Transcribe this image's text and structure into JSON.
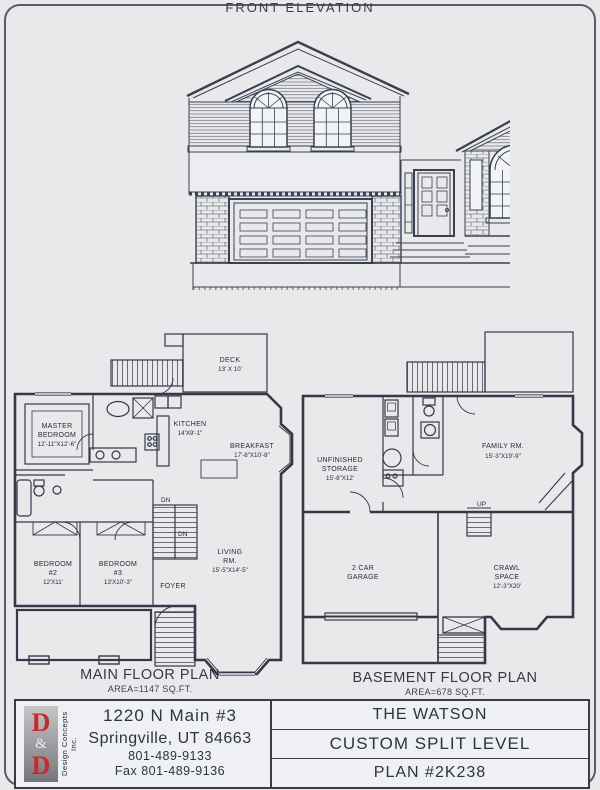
{
  "elevation": {
    "label": "FRONT ELEVATION"
  },
  "main_plan": {
    "title": "MAIN FLOOR PLAN",
    "area": "AREA=1147 SQ.FT.",
    "deck_name": "DECK",
    "deck_size": "13' X 10'",
    "master_l1": "MASTER",
    "master_l2": "BEDROOM",
    "master_size": "12'-11\"X12'-6\"",
    "kitchen_name": "KITCHEN",
    "kitchen_size": "14'X9'-1\"",
    "breakfast_name": "BREAKFAST",
    "breakfast_size": "17'-8\"X10'-8\"",
    "bed2_l1": "BEDROOM",
    "bed2_l2": "#2",
    "bed2_size": "12'X11'",
    "bed3_l1": "BEDROOM",
    "bed3_l2": "#3",
    "bed3_size": "13'X10'-3\"",
    "foyer": "FOYER",
    "living_l1": "LIVING",
    "living_l2": "RM.",
    "living_size": "15'-5\"X14'-5\"",
    "dn1": "DN",
    "dn2": "DN"
  },
  "basement_plan": {
    "title": "BASEMENT FLOOR PLAN",
    "area": "AREA=678 SQ.FT.",
    "storage_l1": "UNFINISHED",
    "storage_l2": "STORAGE",
    "storage_size": "15'-8\"X12'",
    "family_l1": "FAMILY RM.",
    "family_size": "15'-3\"X19'-9\"",
    "garage_l1": "2 CAR",
    "garage_l2": "GARAGE",
    "crawl_l1": "CRAWL",
    "crawl_l2": "SPACE",
    "crawl_size": "12'-3\"X20'",
    "up": "UP"
  },
  "title_block": {
    "logo_d1": "D",
    "logo_amp": "&",
    "logo_d2": "D",
    "logo_side": "Design Concepts Inc.",
    "address_line1": "1220 N Main #3",
    "address_line2": "Springville, UT 84663",
    "phone": "801-489-9133",
    "fax": "Fax 801-489-9136",
    "plan_name": "THE WATSON",
    "plan_type": "CUSTOM SPLIT LEVEL",
    "plan_number": "PLAN #2K238"
  }
}
